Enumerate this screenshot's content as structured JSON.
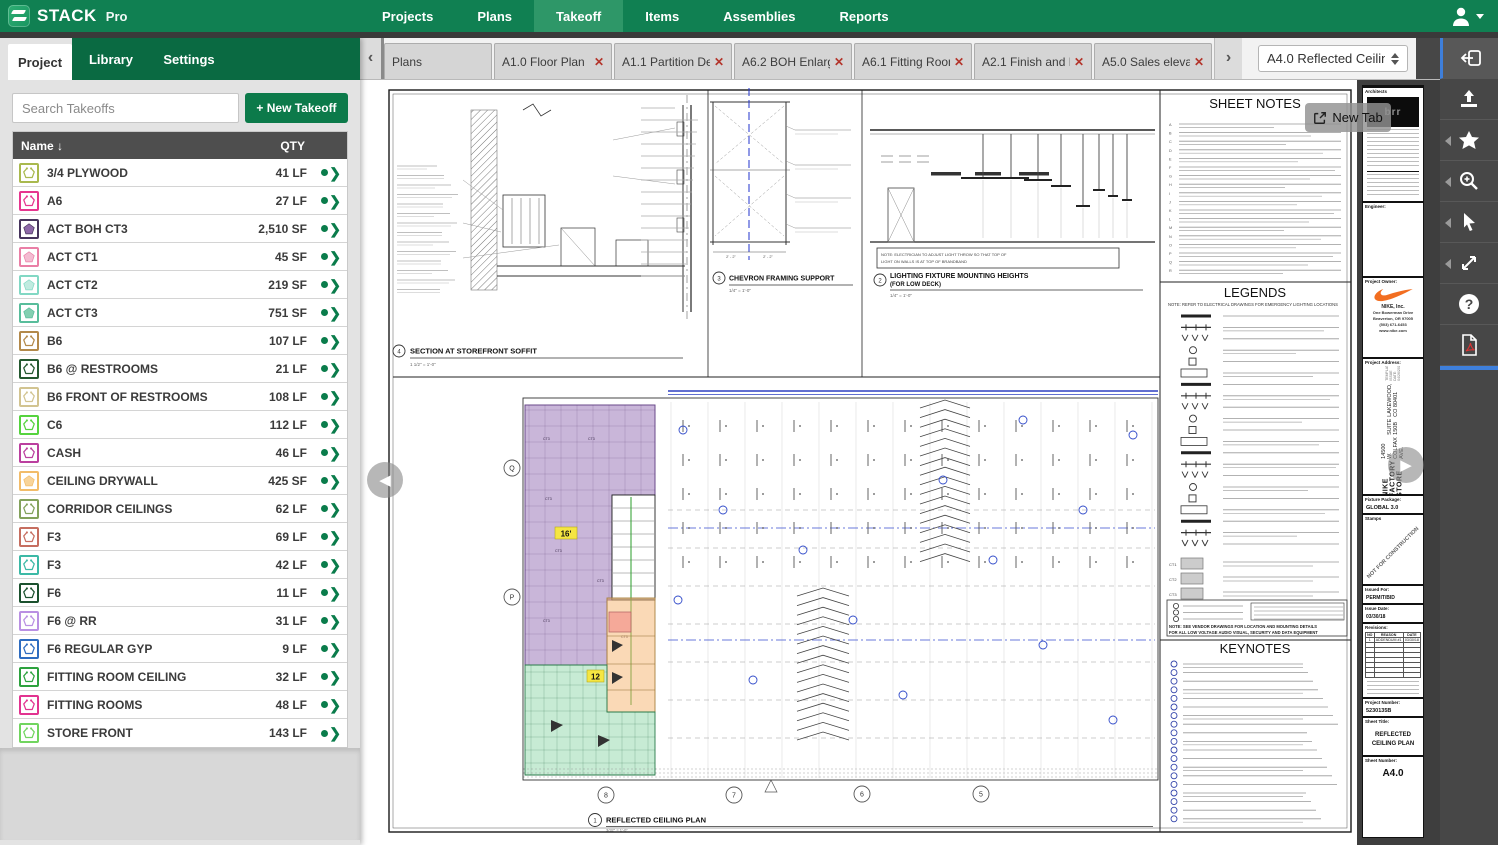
{
  "app": {
    "brand": "STACK",
    "brand_suffix": "Pro"
  },
  "top_nav": {
    "items": [
      "Projects",
      "Plans",
      "Takeoff",
      "Items",
      "Assemblies",
      "Reports"
    ],
    "active_item": "Takeoff"
  },
  "sidebar": {
    "tabs": [
      {
        "label": "Project",
        "active": true
      },
      {
        "label": "Library",
        "active": false
      },
      {
        "label": "Settings",
        "active": false
      }
    ],
    "search_placeholder": "Search Takeoffs",
    "new_takeoff_label": "+ New Takeoff",
    "table": {
      "name_header": "Name ↓",
      "qty_header": "QTY",
      "rows": [
        {
          "name": "3/4 PLYWOOD",
          "qty": "41 LF",
          "filled": false,
          "border": "#a9b94e",
          "glyph": "#a9b94e"
        },
        {
          "name": "A6",
          "qty": "27 LF",
          "filled": false,
          "border": "#e6368f",
          "glyph": "#e6368f"
        },
        {
          "name": "ACT BOH CT3",
          "qty": "2,510 SF",
          "filled": true,
          "border": "#46345c",
          "glyph": "#8e68a8"
        },
        {
          "name": "ACT CT1",
          "qty": "45 SF",
          "filled": true,
          "border": "#ea7fa6",
          "glyph": "#f4bcd2"
        },
        {
          "name": "ACT CT2",
          "qty": "219 SF",
          "filled": true,
          "border": "#82d8c4",
          "glyph": "#c0ebe0"
        },
        {
          "name": "ACT CT3",
          "qty": "751 SF",
          "filled": true,
          "border": "#58bd9b",
          "glyph": "#83cfb1"
        },
        {
          "name": "B6",
          "qty": "107 LF",
          "filled": false,
          "border": "#b3894a",
          "glyph": "#b3894a"
        },
        {
          "name": "B6 @ RESTROOMS",
          "qty": "21 LF",
          "filled": false,
          "border": "#24582f",
          "glyph": "#24582f"
        },
        {
          "name": "B6 FRONT OF RESTROOMS",
          "qty": "108 LF",
          "filled": false,
          "border": "#d2c491",
          "glyph": "#d2c491"
        },
        {
          "name": "C6",
          "qty": "112 LF",
          "filled": false,
          "border": "#56d33e",
          "glyph": "#56d33e"
        },
        {
          "name": "CASH",
          "qty": "46 LF",
          "filled": false,
          "border": "#bb3f9f",
          "glyph": "#bb3f9f"
        },
        {
          "name": "CEILING DRYWALL",
          "qty": "425 SF",
          "filled": true,
          "border": "#f2bc69",
          "glyph": "#f8d49a"
        },
        {
          "name": "CORRIDOR CEILINGS",
          "qty": "62 LF",
          "filled": false,
          "border": "#83a25c",
          "glyph": "#83a25c"
        },
        {
          "name": "F3",
          "qty": "69 LF",
          "filled": false,
          "border": "#c66e60",
          "glyph": "#c66e60"
        },
        {
          "name": "F3",
          "qty": "42 LF",
          "filled": false,
          "border": "#3cb9a6",
          "glyph": "#3cb9a6"
        },
        {
          "name": "F6",
          "qty": "11 LF",
          "filled": false,
          "border": "#1b512e",
          "glyph": "#1b512e"
        },
        {
          "name": "F6 @ RR",
          "qty": "31 LF",
          "filled": false,
          "border": "#ba90e3",
          "glyph": "#ba90e3"
        },
        {
          "name": "F6 REGULAR GYP",
          "qty": "9 LF",
          "filled": false,
          "border": "#2e6cc0",
          "glyph": "#2e6cc0"
        },
        {
          "name": "FITTING ROOM CEILING",
          "qty": "32 LF",
          "filled": false,
          "border": "#2da23e",
          "glyph": "#2da23e"
        },
        {
          "name": "FITTING ROOMS",
          "qty": "48 LF",
          "filled": false,
          "border": "#e23390",
          "glyph": "#e23390"
        },
        {
          "name": "STORE FRONT",
          "qty": "143 LF",
          "filled": false,
          "border": "#71d55f",
          "glyph": "#71d55f"
        }
      ]
    }
  },
  "tab_bar": {
    "tabs": [
      {
        "label": "Plans",
        "closable": false
      },
      {
        "label": "A1.0 Floor Plan",
        "closable": true
      },
      {
        "label": "A1.1 Partition Det",
        "closable": true
      },
      {
        "label": "A6.2 BOH Enlarge",
        "closable": true
      },
      {
        "label": "A6.1 Fitting Room",
        "closable": true
      },
      {
        "label": "A2.1 Finish and M",
        "closable": true
      },
      {
        "label": "A5.0 Sales elevati",
        "closable": true
      }
    ],
    "sheet_select_value": "A4.0 Reflected Ceiling"
  },
  "overlays": {
    "new_tab_label": "New Tab"
  },
  "sheet": {
    "detail_section": {
      "num": "4",
      "title": "SECTION AT STOREFRONT SOFFIT",
      "scale": "1 1/2\" = 1'-0\""
    },
    "detail_chevron": {
      "num": "3",
      "title": "CHEVRON FRAMING SUPPORT",
      "scale": "1/4\" = 1'-0\"",
      "dim_left": "2' - 2\"",
      "dim_right": "2' - 2\""
    },
    "detail_lighting": {
      "num": "2",
      "title": "LIGHTING FIXTURE MOUNTING HEIGHTS",
      "subtitle": "(FOR LOW DECK)",
      "scale": "1/4\" = 1'-0\"",
      "note_line1": "NOTE: ELECTRICIAN TO ADJUST LIGHT THROW SO THAT TOP OF",
      "note_line2": "LIGHT ON WALLS IS AT TOP OF BRANDBAND"
    },
    "sheet_notes_title": "SHEET NOTES",
    "legends_title": "LEGENDS",
    "legends_note": "NOTE:  REFER TO ELECTRICAL DRAWINGS FOR EMERGENCY LIGHTING LOCATIONS",
    "legend_ct_labels": [
      "CT1",
      "CT2",
      "CT3"
    ],
    "legend_bottom_note1": "NOTE: SEE VENDOR DRAWINGS FOR LOCATION AND MOUNTING DETAILS",
    "legend_bottom_note2": "FOR ALL LOW VOLTAGE AUDIO VISUAL, SECURITY AND DATA EQUIPMENT",
    "keynotes_title": "KEYNOTES",
    "plan": {
      "num": "1",
      "title": "REFLECTED CEILING PLAN",
      "scale": "3/32\" = 1'-0\"",
      "height_badge_1": "16'",
      "height_badge_2": "12",
      "tile_label": "CT3",
      "grid_letters": [
        "Q",
        "P"
      ],
      "grid_numbers": [
        "8",
        "7",
        "6",
        "5"
      ]
    }
  },
  "title_block": {
    "architects_label": "Architects",
    "logo_text": "brr",
    "engineer_label": "Engineer:",
    "owner_label": "Project Owner:",
    "owner_name": "NIKE, Inc.",
    "owner_addr1": "One Bowerman Drive",
    "owner_addr2": "Beaverton, OR 97005",
    "owner_addr3": "(503) 671-6453",
    "owner_addr4": "www.nike.com",
    "address_label": "Project Address:",
    "store_name": "NIKE FACTORY STORE",
    "store_addr1": "14500 W. COLFAX AVE.",
    "store_addr2": "SUITE 150B",
    "store_addr3": "LAKEWOOD, CO 80401",
    "template_note": "TEMPLATE ISSUE DATE: 04/26/2017",
    "package_label": "Fixture Package:",
    "package_value": "GLOBAL 3.0",
    "stamps_label": "Stamps",
    "stamp_text": "NOT FOR CONSTRUCTION",
    "issued_label": "Issued For:",
    "issued_value": "PERMIT/BID",
    "issue_date_label": "Issue Date:",
    "issue_date_value": "03/30/18",
    "revisions_label": "Revisions:",
    "revisions_headers": [
      "NO",
      "REASON",
      "DATE"
    ],
    "revisions_rows": [
      [
        "1",
        "ADDENDUM #1",
        "03/30/18"
      ]
    ],
    "project_number_label": "Project Number:",
    "project_number_value": "5230135B",
    "sheet_title_label": "Sheet Title:",
    "sheet_title_value": "REFLECTED CEILING PLAN",
    "sheet_number_label": "Sheet Number:",
    "sheet_number_value": "A4.0"
  }
}
